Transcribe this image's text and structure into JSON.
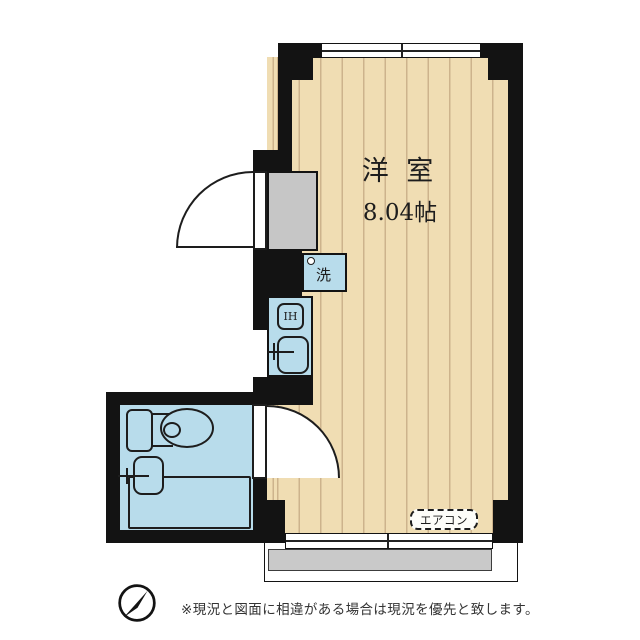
{
  "plan": {
    "room": {
      "name": "洋 室",
      "size": "8.04帖"
    },
    "labels": {
      "washer": "洗",
      "stove": "IH",
      "aircon": "エアコン"
    }
  },
  "footer": {
    "disclaimer": "※現況と図面に相違がある場合は現況を優先と致します。"
  },
  "colors": {
    "floor": "#f0ddb3",
    "floor_line": "#cdb38c",
    "water": "#b8dceb",
    "wall": "#131313",
    "egray": "#c6c6c6",
    "bgray": "#c9c9c9",
    "ink": "#1d1d1d"
  }
}
